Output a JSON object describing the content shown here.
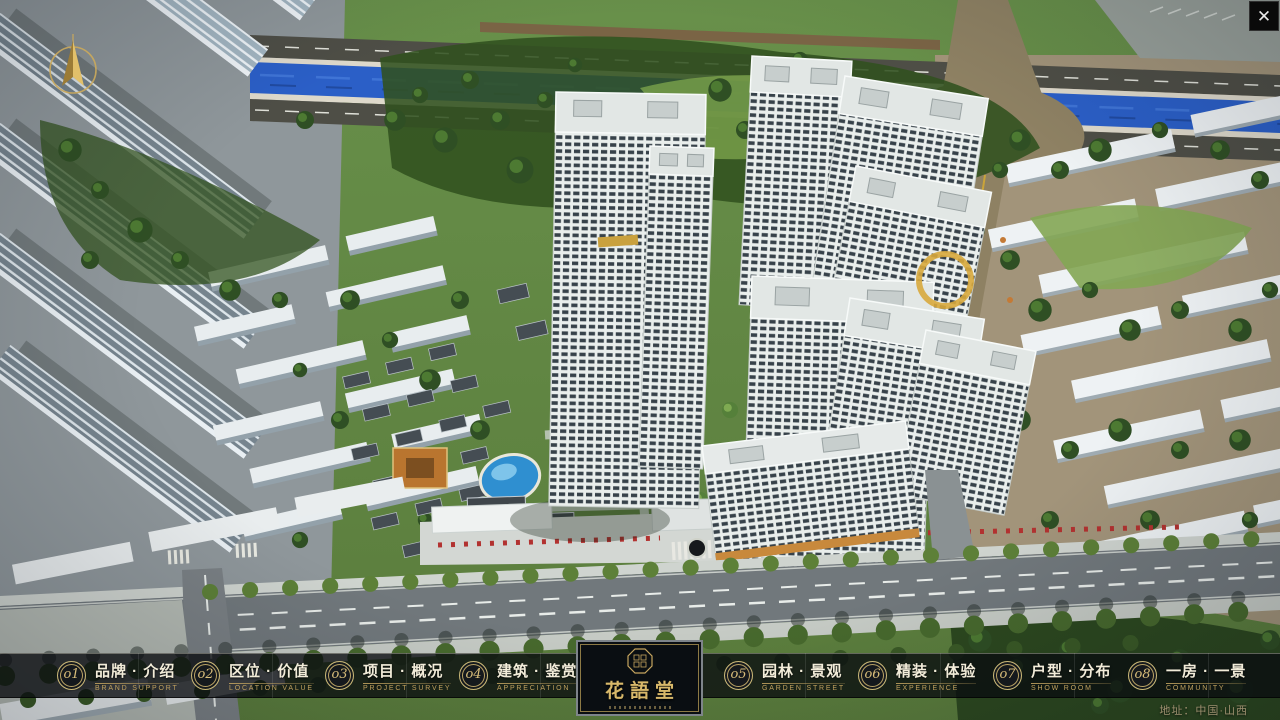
{
  "nav": {
    "items": [
      {
        "num": "o1",
        "zh": "品牌 · 介绍",
        "en": "BRAND SUPPORT"
      },
      {
        "num": "o2",
        "zh": "区位 · 价值",
        "en": "LOCATION VALUE"
      },
      {
        "num": "o3",
        "zh": "项目 · 概况",
        "en": "PROJECT SURVEY"
      },
      {
        "num": "o4",
        "zh": "建筑 · 鉴赏",
        "en": "APPRECIATION"
      },
      {
        "num": "o5",
        "zh": "园林 · 景观",
        "en": "GARDEN STREET"
      },
      {
        "num": "o6",
        "zh": "精装 · 体验",
        "en": "EXPERIENCE"
      },
      {
        "num": "o7",
        "zh": "户型 · 分布",
        "en": "SHOW ROOM"
      },
      {
        "num": "o8",
        "zh": "一房 · 一景",
        "en": "COMMUNITY"
      }
    ]
  },
  "logo": {
    "title": "花語堂"
  },
  "footer": {
    "address": "地址：中国·山西"
  },
  "window": {
    "close_icon": "✕"
  },
  "colors": {
    "gold": "#c6a55f",
    "nav_text": "#f2ecd9",
    "river_blue": "#2b5fc7",
    "tree_green": "#2f4f24",
    "tower_white": "#e9eeec"
  }
}
